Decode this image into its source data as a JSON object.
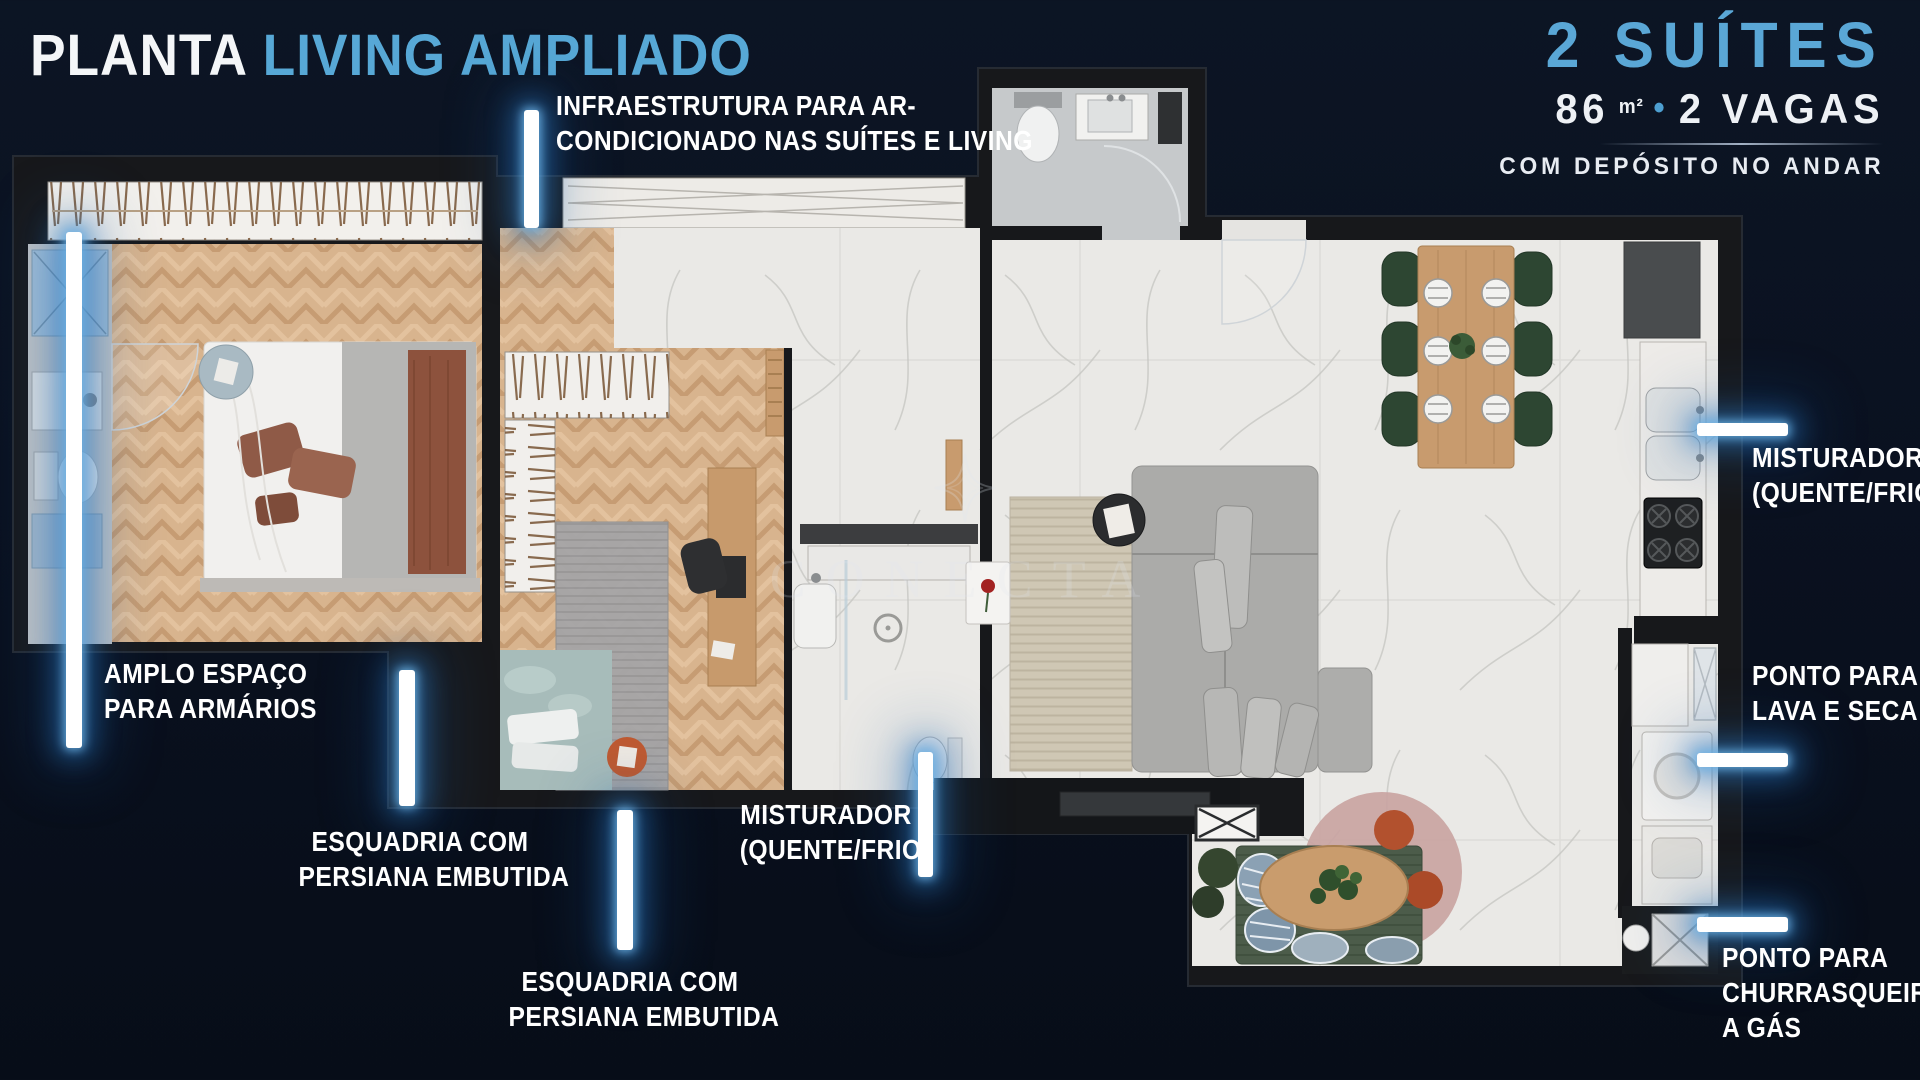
{
  "header": {
    "title": {
      "primary": "PLANTA",
      "secondary": "LIVING AMPLIADO"
    },
    "unit_info": {
      "suites": "2 SUÍTES",
      "area_value": "86",
      "area_unit": "m²",
      "bullet": "•",
      "parking": "2 VAGAS",
      "note": "COM DEPÓSITO NO ANDAR"
    }
  },
  "callouts": {
    "ac": {
      "lines": [
        "INFRAESTRUTURA PARA AR-",
        "CONDICIONADO NAS SUÍTES E LIVING"
      ]
    },
    "closet": {
      "lines": [
        "AMPLO ESPAÇO",
        "PARA ARMÁRIOS"
      ]
    },
    "esquadria1": {
      "lines": [
        "ESQUADRIA COM",
        "PERSIANA EMBUTIDA"
      ]
    },
    "esquadria2": {
      "lines": [
        "ESQUADRIA COM",
        "PERSIANA EMBUTIDA"
      ]
    },
    "misturador_banho": {
      "lines": [
        "MISTURADOR",
        "(QUENTE/FRIO)"
      ]
    },
    "misturador_cozinha": {
      "lines": [
        "MISTURADOR",
        "(QUENTE/FRIO)"
      ]
    },
    "lava_seca": {
      "lines": [
        "PONTO PARA",
        "LAVA E SECA"
      ]
    },
    "churrasqueira": {
      "lines": [
        "PONTO PARA",
        "CHURRASQUEIRA",
        "A GÁS"
      ]
    }
  },
  "watermark": {
    "text": "CONECTA"
  },
  "colors": {
    "background": "#0A1120",
    "accent_blue": "#5AA7D6",
    "glow_blue": "#2F7DC6",
    "wall": "#17181B",
    "wood_floor": "#D8B48E",
    "marble_floor": "#EAE9E6"
  }
}
